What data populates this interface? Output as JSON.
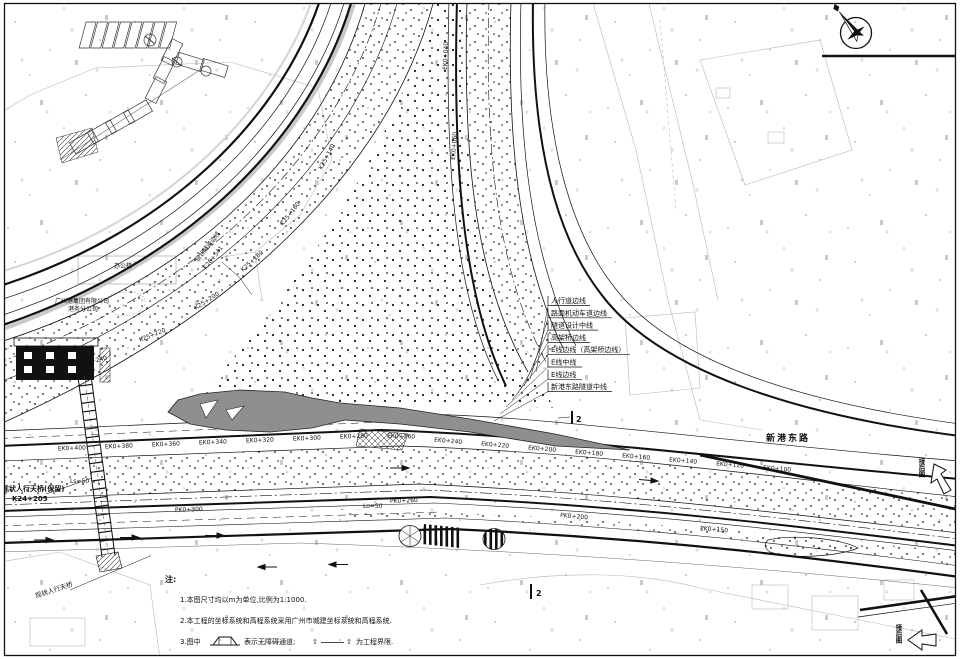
{
  "legend": {
    "items": [
      "人行道边线",
      "路面机动车道边线",
      "隧道设计中线",
      "高架桥边线",
      "E线边线（高架桥边线）",
      "E线中线",
      "E线边线",
      "新港东路隧道中线"
    ]
  },
  "notes": {
    "title": "注:",
    "item1": "1.本图尺寸均以m为单位,比例为1:1000.",
    "item2": "2.本工程的坐标系统和高程系统采用广州市城建坐标系统和高程系统.",
    "item3_prefix": "3.图中",
    "item3_mid": "表示无障碍通道;",
    "item3_gate": "⇧",
    "item3_suffix": "为工程界限."
  },
  "labels": {
    "road_name": "新港东路",
    "office": "办公楼",
    "company_line1": "广州港集团有限公司",
    "company_line2": "港务分公司",
    "bridge_keep_line1": "现状人行天桥(保留)",
    "bridge_keep_line2": "K24+205",
    "bridge_diag": "现状人行天桥",
    "tunnel_edge_line1": "现状隧道边线",
    "tunnel_edge_line2": "K26+541",
    "section_no": "2",
    "match_right": "接后图",
    "match_bottom": "接后图",
    "ls_label": "Ls=50",
    "lo_label": "Lo=50"
  },
  "chainage": {
    "north": [
      "EK0+400",
      "EK0+380",
      "EK0+360",
      "EK0+340",
      "EK0+320",
      "EK0+300",
      "EK0+280",
      "EK0+260",
      "EK0+240",
      "EK0+220",
      "EK0+200",
      "EK0+180",
      "EK0+160",
      "EK0+140",
      "EK0+120",
      "EK0+100"
    ],
    "south": [
      "PK0+300",
      "PK0+260",
      "PK0+200",
      "PK0+150"
    ],
    "curve": [
      "K25+140",
      "K25+160",
      "K25+180",
      "K25+200",
      "K25+220",
      "K25+240"
    ],
    "vertical": [
      "EK0+040",
      "EK0+060"
    ]
  }
}
